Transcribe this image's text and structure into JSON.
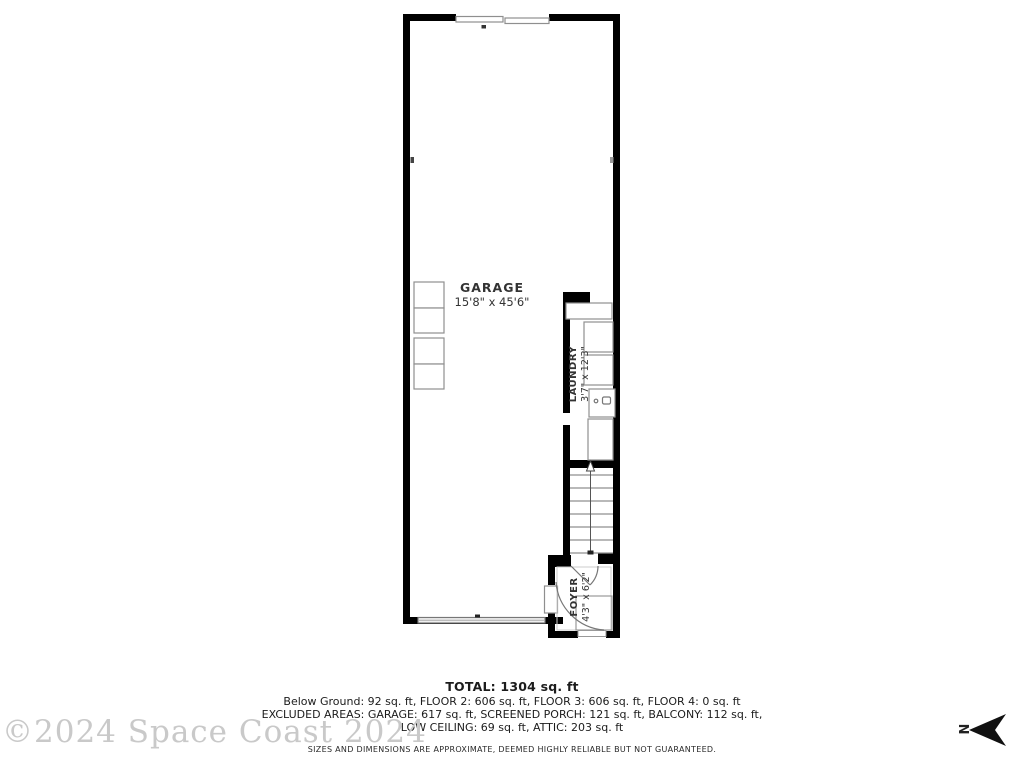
{
  "floor_plan": {
    "rooms": {
      "garage": {
        "label": "GARAGE",
        "dims": "15'8\" x 45'6\""
      },
      "laundry": {
        "label": "LAUNDRY",
        "dims": "3'7\" x 12'3\""
      },
      "foyer": {
        "label": "FOYER",
        "dims": "4'3\" x 6'2\""
      }
    },
    "colors": {
      "wall": "#000000",
      "fixture_line": "#8f8f8f",
      "label_text": "#333333"
    }
  },
  "summary": {
    "total": "TOTAL: 1304 sq. ft",
    "lines": [
      "Below Ground: 92 sq. ft, FLOOR 2: 606 sq. ft, FLOOR 3: 606 sq. ft, FLOOR 4: 0 sq. ft",
      "EXCLUDED AREAS: GARAGE: 617 sq. ft, SCREENED PORCH: 121 sq. ft, BALCONY: 112 sq. ft,",
      "LOW CEILING: 69 sq. ft, ATTIC: 203 sq. ft"
    ],
    "disclaimer": "SIZES AND DIMENSIONS ARE APPROXIMATE, DEEMED HIGHLY RELIABLE BUT NOT GUARANTEED."
  },
  "watermark": {
    "text": "©2024 Space Coast 2024",
    "color": "#c9c9c9"
  },
  "compass": {
    "label": "N"
  }
}
